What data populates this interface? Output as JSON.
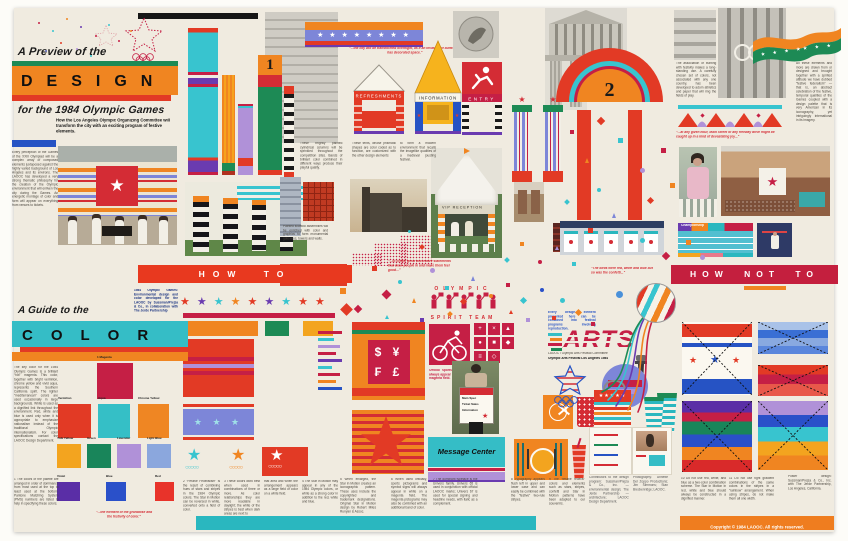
{
  "glyphs": {
    "star": "★",
    "stars3": "★ ★ ★",
    "stars4": "★ ★ ★ ★",
    "stars5": "★★★★★",
    "stars8": "★ ★ ★ ★ ★ ★ ★ ★",
    "rings": "○○○○○"
  },
  "header": {
    "eyebrow": "A Preview of the",
    "title": "DESIGN",
    "subtitle": "for the 1984 Olympic Games",
    "tagline": "How the Los Angeles Olympic Organizing Committee will transform the city with an exciting program of festive elements."
  },
  "intro": "Every perception of the Games of the XXIII Olympiad will be a complex array of composed elements juxtaposed against the highly varied background of Los Angeles and its environs. The LAOOC has developed a very strong thematic philosophy for the creation of the Olympic environment that will enliven the city during the Games. An energetic montage of color and form will appear on everything from venues to tickets.",
  "top": {
    "column_number": "1",
    "arch_number": "2"
  },
  "kiosks": {
    "refreshments": "REFRESHMENTS",
    "information": "INFORMATION",
    "entry": "ENTRY"
  },
  "top_captions": {
    "columns": "These brightly painted cylindrical columns will be sprinkled throughout the competition sites. Bands of brilliant color combined in different ways produce their playful quality.",
    "tents": "These tents, whose prismatic shapes are color coded as to function, are customized with the other design elements",
    "festival": "to form a modern environment that recalls the imagelike qualities of a medieval jousting festival.",
    "scaffold": "Painted scaffold assemblies will be enriched with color and graphics to form monumental gateways, towers and walls.",
    "bunting": "The association of bunting with festivity makes a long-standing use. A carefully chosen set of colors, not associated with any one country, has been developed to adorn athletics and paper that will ring the fields of play.",
    "festive_federalism": "All these elements and more are drawn from or designed and brought together with a spirited attitude we have dubbed “festive federalism” — that is, an abstract celebration of the festive, temporal qualities of the Games coupled with a design palette that is very American in its iconography, yet intriguingly international in its imagery."
  },
  "quotes": {
    "butterflies": "“...the city will be transformed overnight, as if an invasion of butterflies has decorated space.”",
    "main_street": "“...at any given hour, Main Street or any freeway drive might be caught up in a kind of devastating joy...”",
    "decorative": "“...to create great decorative statements that draw people in and make them feel good...”",
    "birds": "“The birds were red, white and blue but so was the confetti...”",
    "grandiose": "“...the element of the grandiose and the festivity of color.”"
  },
  "how_to": {
    "label": "HOW TO",
    "credit": "1984 Olympic Games: Environmental design and color developed for the LAOOC by Sussman/Prejza & Co., in collaboration with The Jerde Partnership",
    "star_colors": [
      "#e23a25",
      "#6a3bb0",
      "#38c4cf",
      "#f08521",
      "#e23a25",
      "#6a3bb0",
      "#38c4cf",
      "#e23a25",
      "#e23a25"
    ]
  },
  "how_not_to": {
    "label": "HOW NOT TO",
    "caption_10": "10  Do not use red, white, and blue as a two-color combination scheme. The Star in Motion in red, white and blue should always be constructed in a dignified manner.",
    "caption_11": "11  Do not use tight gradient combinations of the same colors in the stripes in a “rainbow” arrangement. When using stripes, do not make them all one width.",
    "design_credit": "Poster design: Sussman/Prejza & Co., Inc. with The Jerde Partnership, Los Angeles, California."
  },
  "color_guide": {
    "eyebrow": "A Guide to the",
    "title": "COLOR",
    "intro": "The key color for the 1984 Olympic Games is a brilliant “hot” magenta. This color, together with bright vermilion, chrome yellow and vivid aqua, represents the Southern California spirit. The lighter “mediterranean” colors are used occasionally in large backgrounds. White is used as a dignified link throughout the environment. Red, white and blue is used only when it is appropriate to emphasize nationalism instead of the traditional Olympic internationalism. For color specifications contact the LAOOC Design Department.",
    "caption_palette": "1  The colors of the palette are arranged in order of dominance from most used at the top to least used at the bottom. Pantone Matching System (PMS) numbers are listed to help in specifying these colors.",
    "swatches": [
      {
        "name": "1 Magenta",
        "hex": "#c51f45"
      },
      {
        "name": "Vermilion",
        "hex": "#e23a25"
      },
      {
        "name": "Aqua",
        "hex": "#35bfc6"
      },
      {
        "name": "Chrome Yellow",
        "hex": "#ef8623"
      },
      {
        "name": "Yolk Yellow",
        "hex": "#f3a41f"
      },
      {
        "name": "Green",
        "hex": "#19855a"
      },
      {
        "name": "Lavender",
        "hex": "#b091d8"
      },
      {
        "name": "Light Blue",
        "hex": "#8ba7dd"
      },
      {
        "name": "Violet",
        "hex": "#5a2ea6"
      },
      {
        "name": "Blue",
        "hex": "#2a50c9"
      },
      {
        "name": "Red",
        "hex": "#e8332a"
      }
    ]
  },
  "star_captions": {
    "c2": "2  “Festive Federalism” is the result of combining hues of stars and stripes in the 1984 Olympic colors. The Star in Motion can be reversed in white, converted onto a field of color.",
    "c3": "3  These colors work best when used in combinations of three or more. As color relationships they are more readable in daylight; the white of the stripes is best when dark areas are next to",
    "c3b": "that area and when the arrangement appears as a large field of color on a white field.",
    "c4": "4  The Star in Motion may appear in any of the 1984 Olympic colors, or white as a strong color in addition to the red, white and blue."
  },
  "mid_captions": {
    "c5": "5  When enlarged, the Star in Motion creates an iconographic pattern. These uses include the copyrighted and trademark designations. Original Star in Motion design by Robert Miles Runyan & Assoc.",
    "c6": "6  When used officially, sports pictograms and symbol signs will always appear in white on a magenta field. The magenta pictograms may also be combined with an additional band of color.",
    "c7": "7  The dominant typeface is the Univers family. Univers 65 is used in conjunction with official LAOOC marks; Univers 67 is used for special signing and headline needs, with italic as a complement.",
    "c8": "8  Typography appears flush left in upper and lower case and can easily be combined with the “festive” two-rule stripes.",
    "c9": "9  The “festive federal” colors and elements such as stars, stripes, confetti and Star in Motion patterns have been adapted to our souvenirs.",
    "picto": "Official sports pictograms always appear in white on a magenta field."
  },
  "signs": {
    "message_center": "Message Center",
    "vip": "VIP RECEPTION",
    "currency_top": "$ ¥",
    "currency_bottom": "₣ £",
    "championship": "Championship",
    "sign_lines": [
      "Main Spec",
      "Ticket Sales",
      "Information"
    ]
  },
  "spirit": {
    "top": "OLYMPIC",
    "bottom": "SPIRIT TEAM"
  },
  "arts": {
    "caption": "Every design element presented here can be combined into festival programs involving reproduction.",
    "title": "ARTS",
    "credit_line": "LAOOC / Olympic Arts Festival Committee",
    "subtitle": "Olympic Arts Festival Los Angeles 1984"
  },
  "footer": {
    "copyright": "Copyright © 1984 LAOOC. All rights reserved.",
    "credits_a": "Contributors to the design program: Sussman/Prejza & Co., Inc. — environmental design; The Jerde Partnership — architecture; LAOOC Design Department.",
    "credits_b": "Photography: Annette Del Zoppo Productions; Jim Simmons; Stan Breckenridge; LAOOC."
  },
  "pictograms": {
    "glyphs": [
      "+",
      "×",
      "▲",
      "●",
      "■",
      "◆",
      "≡",
      "◇"
    ]
  },
  "confetti": [
    [
      38,
      22,
      2,
      "ci",
      "#c51f45"
    ],
    [
      52,
      30,
      2,
      "ci",
      "#38c4cf"
    ],
    [
      66,
      18,
      2,
      "ci",
      "#f08521"
    ],
    [
      80,
      26,
      2,
      "ci",
      "#6a3bb0"
    ],
    [
      95,
      35,
      2,
      "ci",
      "#c51f45"
    ],
    [
      60,
      42,
      2,
      "ci",
      "#e23a25"
    ],
    [
      45,
      50,
      2,
      "ci",
      "#7d86d8"
    ],
    [
      108,
      24,
      2,
      "ci",
      "#38c4cf"
    ],
    [
      118,
      40,
      2,
      "ci",
      "#c51f45"
    ],
    [
      130,
      30,
      2,
      "ci",
      "#f08521"
    ],
    [
      76,
      48,
      2,
      "ci",
      "#b091d8"
    ],
    [
      90,
      55,
      2,
      "ci",
      "#38c4cf"
    ],
    [
      598,
      118,
      6,
      "di",
      "#e23a25"
    ],
    [
      618,
      138,
      5,
      "sq",
      "#38c4cf"
    ],
    [
      585,
      158,
      5,
      "tr",
      "#f08521"
    ],
    [
      640,
      168,
      5,
      "ci",
      "#b091d8"
    ],
    [
      661,
      148,
      5,
      "sq",
      "#c51f45"
    ],
    [
      597,
      188,
      4,
      "ci",
      "#38c4cf"
    ],
    [
      648,
      198,
      5,
      "di",
      "#e23a25"
    ],
    [
      670,
      183,
      5,
      "sq",
      "#f08521"
    ],
    [
      612,
      213,
      5,
      "tr",
      "#7d86d8"
    ],
    [
      588,
      228,
      5,
      "sq",
      "#e23a25"
    ],
    [
      640,
      238,
      5,
      "ci",
      "#38c4cf"
    ],
    [
      663,
      253,
      6,
      "di",
      "#c51f45"
    ],
    [
      686,
      240,
      5,
      "sq",
      "#f08521"
    ],
    [
      700,
      255,
      5,
      "ci",
      "#b091d8"
    ],
    [
      570,
      130,
      4,
      "sq",
      "#c51f45"
    ],
    [
      565,
      200,
      4,
      "di",
      "#38c4cf"
    ],
    [
      340,
      288,
      6,
      "sq",
      "#f08521"
    ],
    [
      355,
      306,
      6,
      "di",
      "#c51f45"
    ],
    [
      372,
      266,
      5,
      "sq",
      "#e23a25"
    ],
    [
      383,
      291,
      7,
      "di",
      "#c51f45"
    ],
    [
      398,
      280,
      4,
      "ci",
      "#38c4cf"
    ],
    [
      412,
      298,
      5,
      "tr",
      "#f08521"
    ],
    [
      430,
      268,
      5,
      "ci",
      "#b091d8"
    ],
    [
      445,
      286,
      4,
      "sq",
      "#38c4cf"
    ],
    [
      461,
      299,
      5,
      "di",
      "#e23a25"
    ],
    [
      471,
      276,
      5,
      "tr",
      "#7d86d8"
    ],
    [
      489,
      294,
      4,
      "ci",
      "#f08521"
    ],
    [
      506,
      283,
      4,
      "sq",
      "#c51f45"
    ],
    [
      521,
      298,
      5,
      "di",
      "#38c4cf"
    ],
    [
      540,
      288,
      4,
      "ci",
      "#2a50c9"
    ],
    [
      509,
      310,
      4,
      "tr",
      "#e23a25"
    ],
    [
      526,
      318,
      4,
      "sq",
      "#b091d8"
    ],
    [
      560,
      298,
      5,
      "ci",
      "#38c4cf"
    ],
    [
      576,
      310,
      5,
      "di",
      "#f08521"
    ],
    [
      591,
      322,
      4,
      "sq",
      "#c51f45"
    ],
    [
      616,
      291,
      7,
      "ci",
      "#4a90d9"
    ],
    [
      385,
      315,
      4,
      "tr",
      "#38c4cf"
    ],
    [
      420,
      318,
      4,
      "sq",
      "#6a3bb0"
    ],
    [
      448,
      312,
      4,
      "di",
      "#f08521"
    ],
    [
      478,
      306,
      3,
      "ci",
      "#c51f45"
    ],
    [
      552,
      316,
      4,
      "sq",
      "#e23a25"
    ],
    [
      505,
      258,
      4,
      "di",
      "#38c4cf"
    ],
    [
      520,
      242,
      4,
      "sq",
      "#f08521"
    ],
    [
      538,
      260,
      4,
      "ci",
      "#c51f45"
    ],
    [
      555,
      246,
      4,
      "tr",
      "#b091d8"
    ],
    [
      572,
      262,
      4,
      "sq",
      "#38c4cf"
    ],
    [
      420,
      245,
      4,
      "di",
      "#e23a25"
    ],
    [
      408,
      230,
      3,
      "ci",
      "#38c4cf"
    ]
  ]
}
